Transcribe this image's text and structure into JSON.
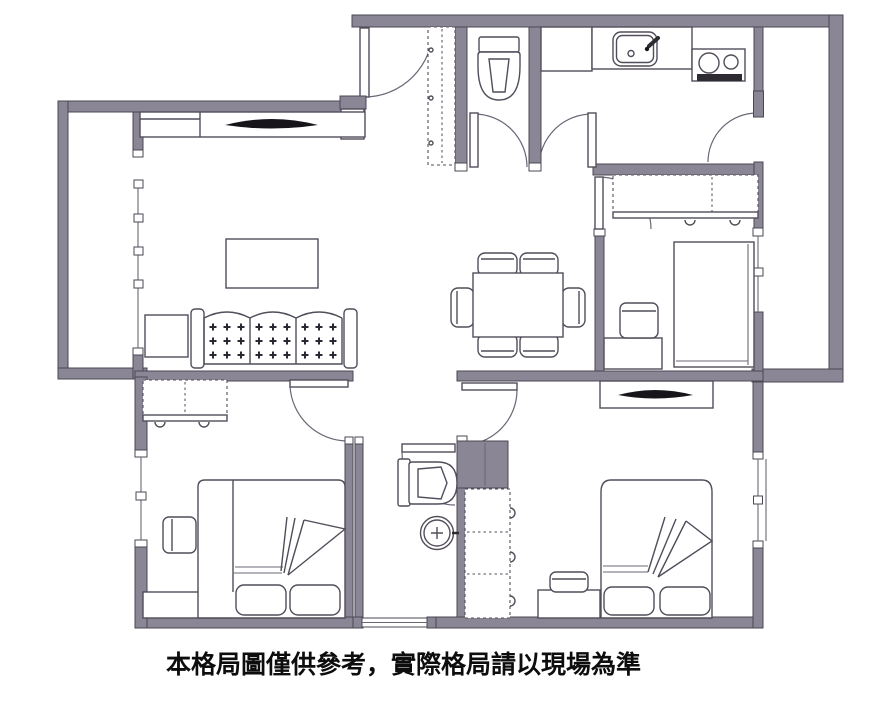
{
  "floor_plan": {
    "disclaimer_text": "本格局圖僅供參考，實際格局請以現場為準",
    "colors": {
      "background": "#ffffff",
      "wall_fill": "#8b8695",
      "wall_outline": "#4b4754",
      "furniture_line": "#524d5a",
      "tv_screen": "#17151a",
      "shower_block": "#8b8594",
      "text": "#0d0d0d"
    },
    "rooms": [
      {
        "name": "entry",
        "furniture": [
          "entry-step",
          "entrance-door",
          "shoe-cabinet"
        ]
      },
      {
        "name": "toilet-room",
        "furniture": [
          "toilet"
        ]
      },
      {
        "name": "kitchen",
        "furniture": [
          "counter",
          "sink",
          "gas-stove-2-burners"
        ]
      },
      {
        "name": "living-room",
        "furniture": [
          "tv-cabinet",
          "tv",
          "sofa-3-seat",
          "coffee-table",
          "side-table"
        ]
      },
      {
        "name": "dining-area",
        "furniture": [
          "dining-table",
          "chairs-x6"
        ]
      },
      {
        "name": "balcony-left",
        "furniture": [
          "window-wall"
        ]
      },
      {
        "name": "utility-balcony-right",
        "furniture": [
          "balcony-door"
        ]
      },
      {
        "name": "bedroom-right",
        "furniture": [
          "wardrobe",
          "single-bed",
          "stool",
          "desk"
        ]
      },
      {
        "name": "bedroom-bottom-left",
        "furniture": [
          "wardrobe",
          "double-bed",
          "pillows-x2",
          "chair",
          "dresser"
        ]
      },
      {
        "name": "bedroom-bottom-right",
        "furniture": [
          "tv-console",
          "tv",
          "double-bed",
          "pillows-x2",
          "stool",
          "dresser",
          "storage-block",
          "tall-cabinet"
        ]
      },
      {
        "name": "bathroom",
        "furniture": [
          "toilet",
          "round-washbasin",
          "window"
        ]
      },
      {
        "name": "hallway",
        "furniture": []
      }
    ],
    "door_count": 8
  }
}
